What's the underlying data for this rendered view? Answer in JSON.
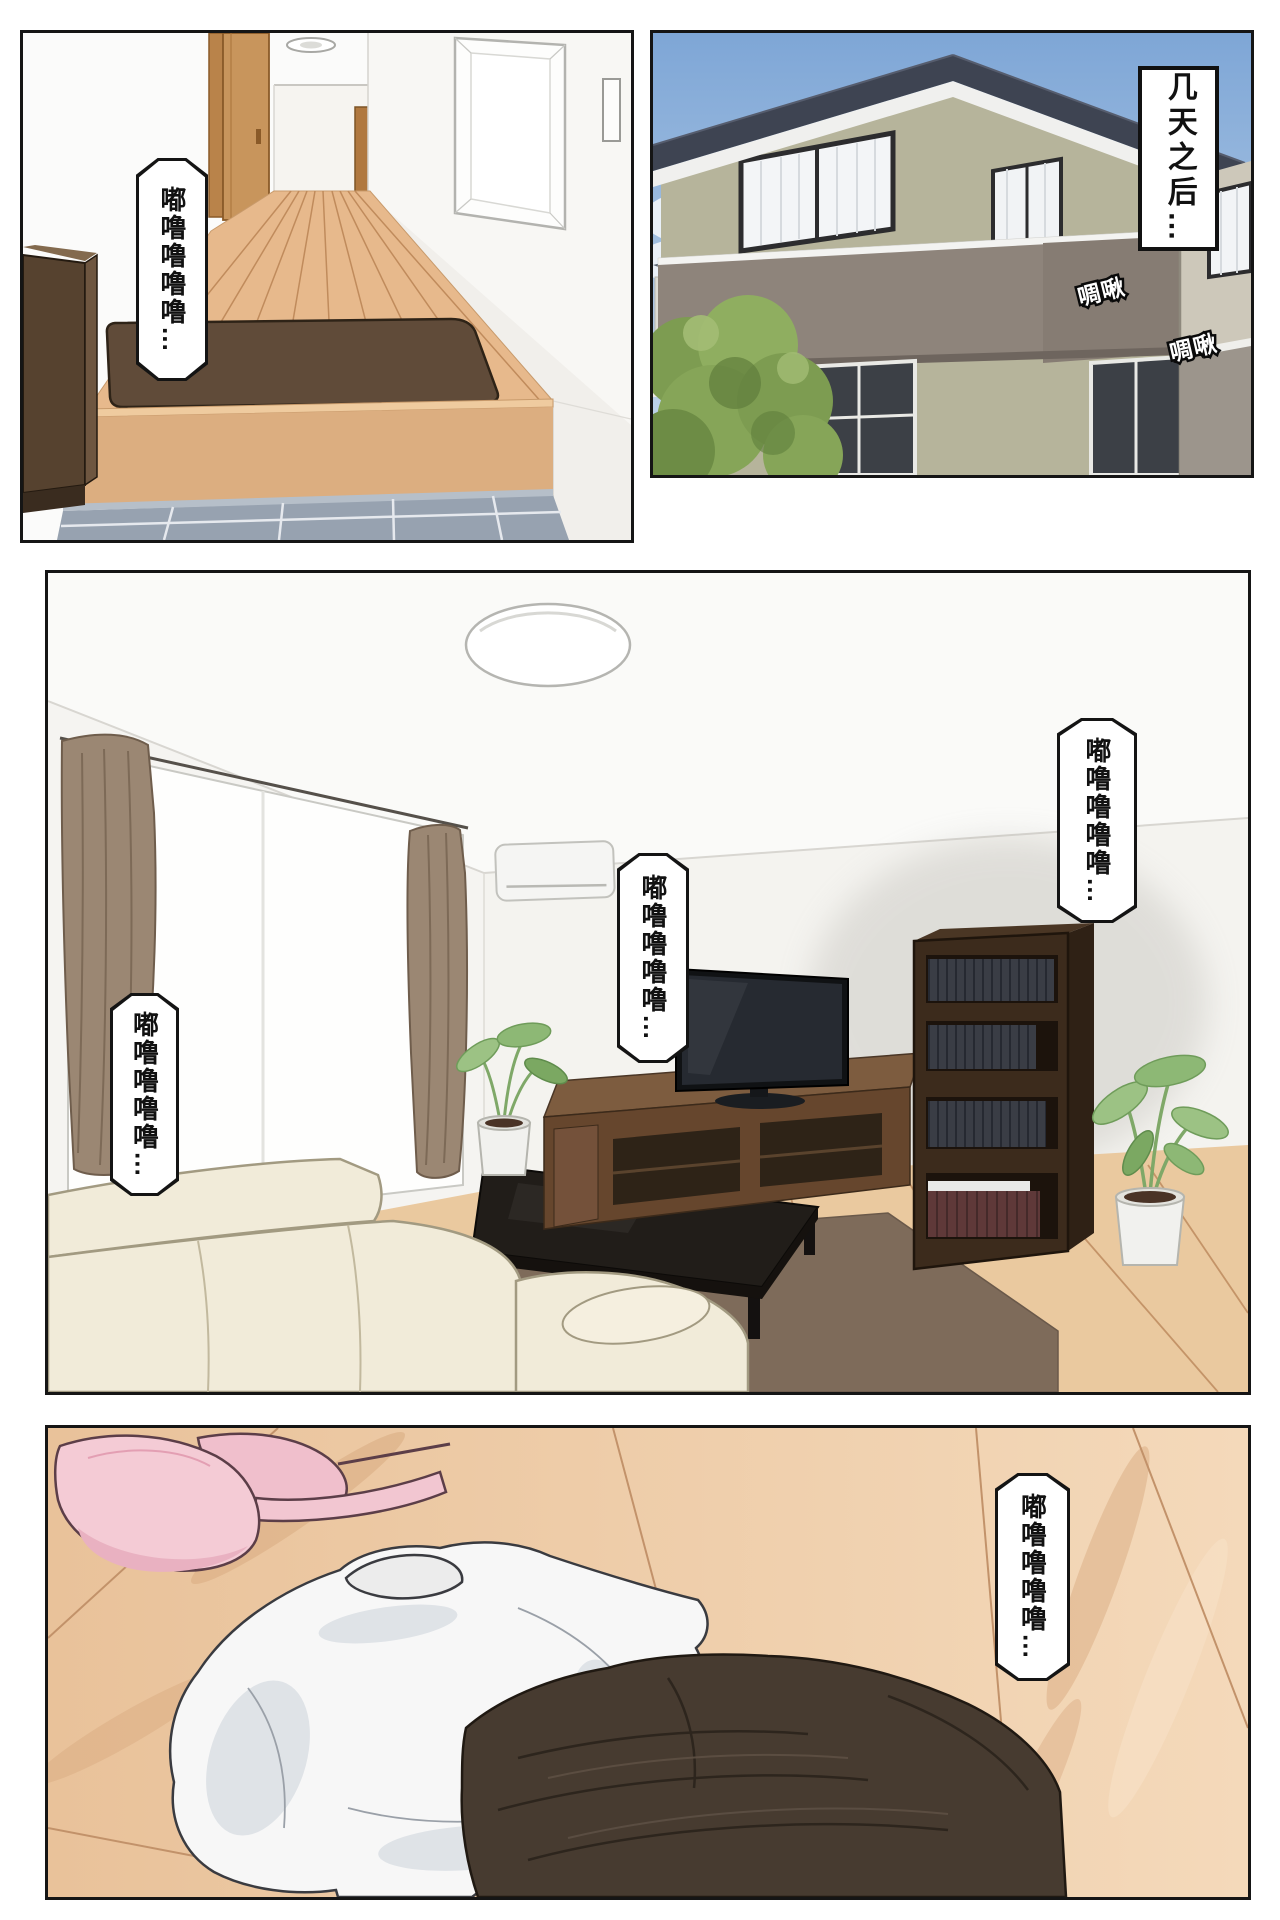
{
  "page": {
    "type": "comic-page",
    "background": "#ffffff",
    "panel_border_color": "#151515"
  },
  "panel_hallway": {
    "label": "entryway-hallway-interior",
    "bubble": {
      "text": "嘟噜噜噜噜…"
    }
  },
  "panel_exterior": {
    "label": "house-exterior",
    "caption": {
      "text": "几天之后…"
    },
    "sfx": [
      {
        "text": "啁啾"
      },
      {
        "text": "啁啾"
      }
    ]
  },
  "panel_living_room": {
    "label": "living-room-interior",
    "bubbles": [
      {
        "position": "left",
        "text": "嘟噜噜噜噜…"
      },
      {
        "position": "center",
        "text": "嘟噜噜噜噜…"
      },
      {
        "position": "right",
        "text": "嘟噜噜噜噜…"
      }
    ]
  },
  "panel_floor_clothes": {
    "label": "clothes-on-floor",
    "bubble": {
      "text": "嘟噜噜噜噜…"
    }
  },
  "palette": {
    "sky": "#7ea6d6",
    "roof": "#3e4452",
    "house_wall": "#b6b49b",
    "balcony_wall": "#8e847b",
    "tree_green": "#86a558",
    "hall_wood": "#e7b98c",
    "genkan_mat": "#604b39",
    "tile_floor": "#97a2b0",
    "living_floor": "#eac99f",
    "sofa_cream": "#f1ebd9",
    "curtain_brown": "#9b8773",
    "bookshelf_brown": "#3c2b1c",
    "rug_brown": "#7e6b5a",
    "bra_pink": "#f4cbd5",
    "shirt_white": "#f7f7f7",
    "garment_dark": "#473b30"
  }
}
